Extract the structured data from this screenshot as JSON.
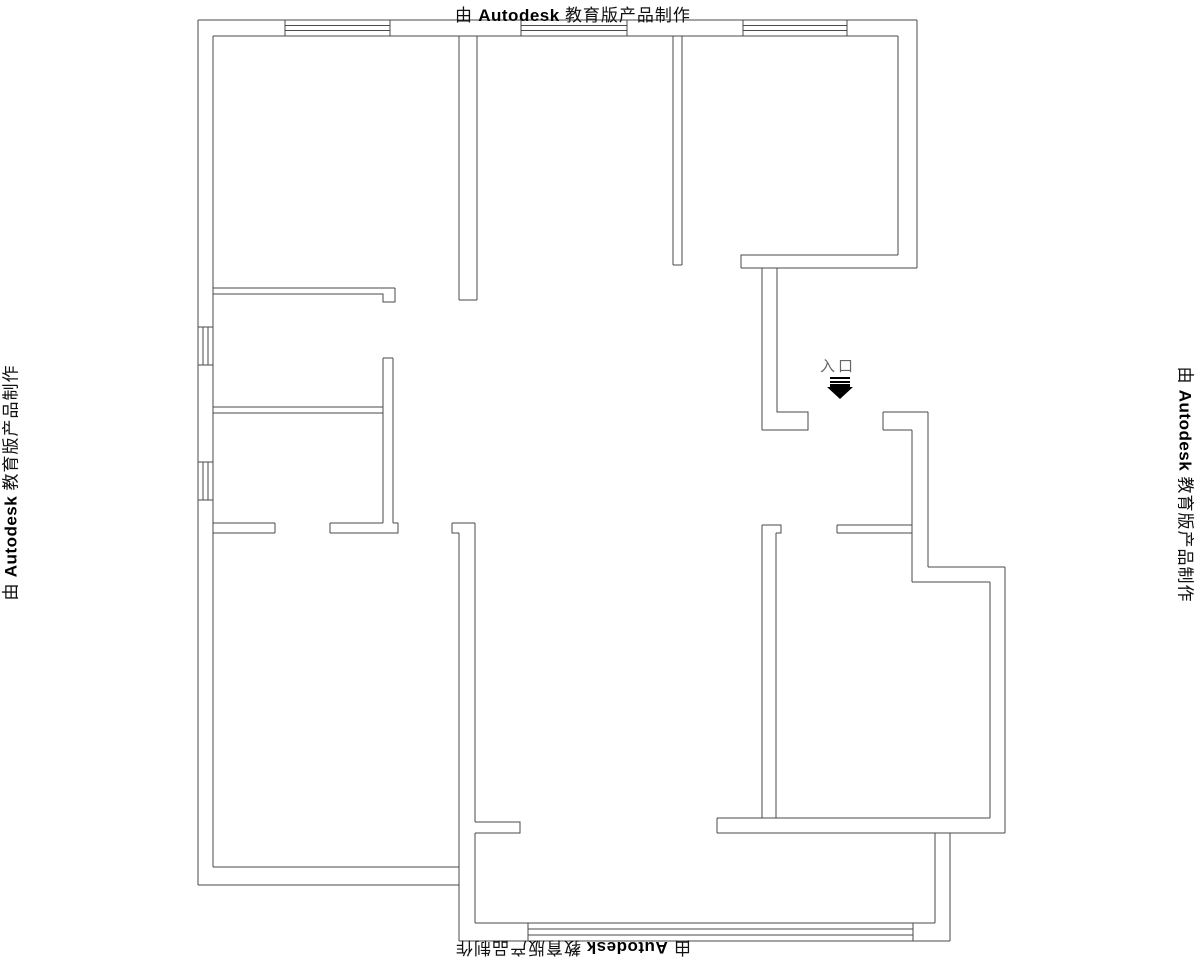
{
  "watermark": {
    "prefix": "由",
    "brand": "Autodesk",
    "suffix": "教育版产品制作",
    "full": "由 Autodesk 教育版产品制作"
  },
  "entrance": {
    "label": "入口"
  },
  "colors": {
    "line": "#4a4a4a",
    "watermark_text": "#111111",
    "background": "#ffffff",
    "entrance_arrow": "#000000",
    "entrance_label": "#666666"
  },
  "floor_plan": {
    "width": 1200,
    "height": 960,
    "segments": [
      {
        "name": "exterior-top-wall-outer",
        "d": "M198,20 L917,20"
      },
      {
        "name": "exterior-top-wall-inner",
        "d": "M213,36 L898,36"
      },
      {
        "name": "exterior-left-wall-outer",
        "d": "M198,20 L198,885"
      },
      {
        "name": "exterior-left-wall-inner",
        "d": "M213,36 L213,867"
      },
      {
        "name": "exterior-right-wall-outer",
        "d": "M917,20 L917,268"
      },
      {
        "name": "exterior-right-wall-inner",
        "d": "M898,36 L898,255"
      },
      {
        "name": "window-top-left",
        "d": "M285,20 L285,36 M390,20 L390,36 M285,25.3 L390,25.3 M285,30.7 L390,30.7"
      },
      {
        "name": "window-top-middle",
        "d": "M521,20 L521,36 M627,20 L627,36 M521,25.3 L627,25.3 M521,30.7 L627,30.7"
      },
      {
        "name": "window-top-right",
        "d": "M743,20 L743,36 M847,20 L847,36 M743,25.3 L847,25.3 M743,30.7 L847,30.7"
      },
      {
        "name": "window-left-upper",
        "d": "M198,327 L213,327 M198,365 L213,365 M203,327 L203,365 M208,327 L208,365"
      },
      {
        "name": "window-left-lower",
        "d": "M198,462 L213,462 M198,500 L213,500 M203,462 L203,500 M208,462 L208,500"
      },
      {
        "name": "divider-topleft-topmiddle",
        "d": "M459,36 L459,300 M477,36 L477,300 M459,300 L477,300"
      },
      {
        "name": "divider-topmiddle-topright",
        "d": "M673,36 L673,265 M682,36 L682,265 M673,265 L682,265"
      },
      {
        "name": "topleft-room-south-wall",
        "d": "M213,288 L395,288 M213,294 L383,294 L383,302 L395,302 L395,288"
      },
      {
        "name": "left-rooms-divider-wall",
        "d": "M213,407 L383,407 M213,413 L383,413"
      },
      {
        "name": "left-rooms-east-wall",
        "d": "M383,358 L393,358 M383,358 L383,523 M393,358 L393,523"
      },
      {
        "name": "bottomleft-room-north-wall-left",
        "d": "M213,523 L275,523 M213,533 L275,533 M275,523 L275,533"
      },
      {
        "name": "bottomleft-room-north-wall-right",
        "d": "M330,523 L383,523 M330,533 L398,533 L398,523 L393,523 M330,523 L330,533"
      },
      {
        "name": "topright-room-south-wall",
        "d": "M747,255 L898,255 M741,268 L917,268 M741,268 L741,255 L747,255"
      },
      {
        "name": "entry-hall-west-wall",
        "d": "M762,268 L762,430 M777,268 L777,412 L808,412 L808,430 L762,430"
      },
      {
        "name": "right-step-wall-top",
        "d": "M883,412 L928,412 M883,430 L912,430 M883,412 L883,430"
      },
      {
        "name": "right-step-wall-vertical",
        "d": "M912,430 L912,582 M928,412 L928,567"
      },
      {
        "name": "right-step-wall-horizontal",
        "d": "M928,567 L1005,567 M912,582 L990,582"
      },
      {
        "name": "bottomright-room-east-wall",
        "d": "M990,582 L990,818 M1005,567 L1005,833"
      },
      {
        "name": "bottomright-room-south-wall",
        "d": "M717,818 L990,818 M717,833 L1005,833 M717,818 L717,833"
      },
      {
        "name": "bottomright-room-west-wall",
        "d": "M762,525 L781,525 L781,533 L776,533 M762,525 L762,818 M776,533 L776,818"
      },
      {
        "name": "bottomright-room-north-wall",
        "d": "M837,525 L912,525 M837,533 L912,533 M837,525 L837,533"
      },
      {
        "name": "bottomleft-room-south-wall",
        "d": "M213,867 L459,867 M198,885 L459,885"
      },
      {
        "name": "bottomleft-room-east-wall",
        "d": "M452,523 L475,523 M452,523 L452,533 L459,533 M459,533 L459,941 M475,523 L475,822 M475,822 L520,822 L520,833 L475,833 M475,833 L475,923"
      },
      {
        "name": "balcony-south-wall-window",
        "d": "M475,923 L935,923 M459,941 L950,941 M528,929 L913,929 M528,935 L913,935 M528,923 L528,941 M913,923 L913,941"
      },
      {
        "name": "balcony-east-wall",
        "d": "M935,833 L935,923 M950,833 L950,941"
      }
    ]
  }
}
